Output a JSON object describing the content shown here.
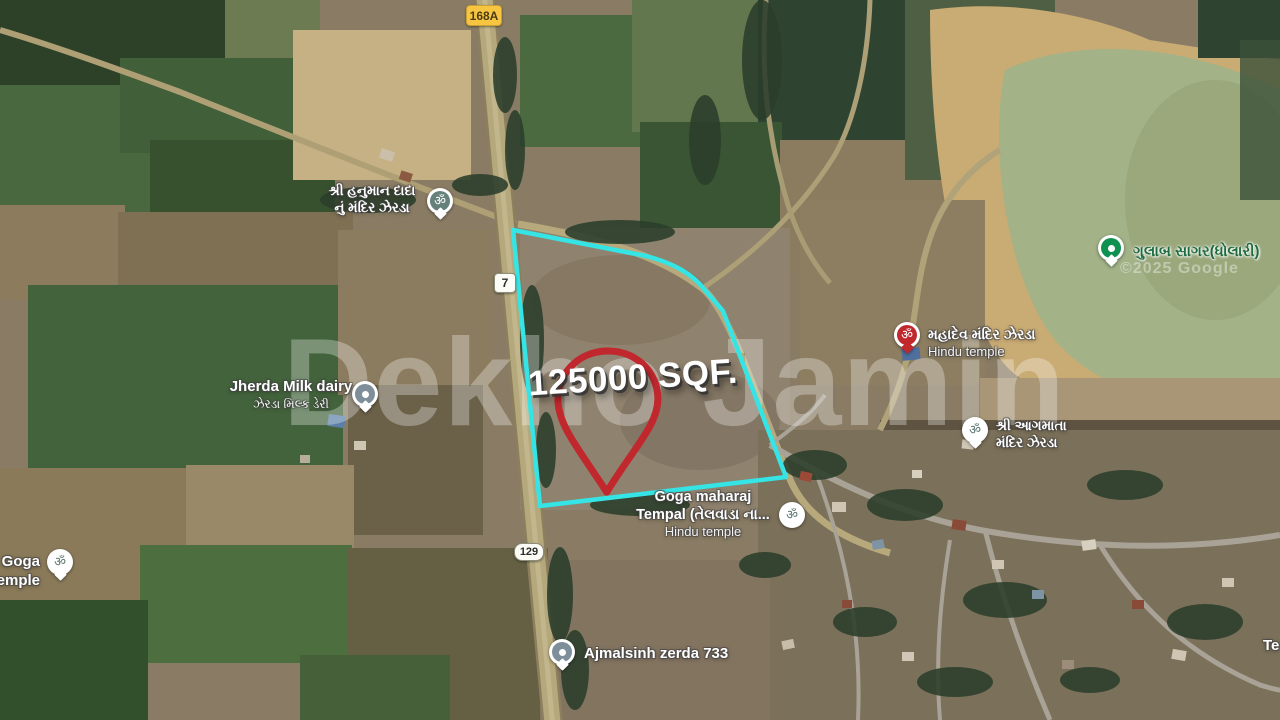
{
  "map": {
    "description": "Satellite map of land parcel for sale near Jherda (Zerda) village"
  },
  "watermark": {
    "text": "Dekho Jamin"
  },
  "credit": {
    "text": "©2025 Google"
  },
  "parcel": {
    "area_label": "125000 SQF."
  },
  "colors": {
    "accent_cyan": "#35e4e4",
    "pin_red": "#c0282e",
    "sign_yellow": "#f7c542",
    "gulab_green": "#0f9150",
    "gulab_text": "#1e6b40"
  },
  "road_signs": {
    "sign_168a": "168A",
    "sign_7": "7",
    "sign_129": "129"
  },
  "places": {
    "hanuman_temple": {
      "line1": "શ્રી હનુમાન દાદા",
      "line2": "નું મંદિર ઝેરડા"
    },
    "milk_dairy": {
      "line1": "Jherda Milk dairy",
      "line2": "ઝેરડા મિલ્ક ડેરી"
    },
    "mahadev_temple": {
      "line1": "મહાદેવ મંદિર ઝેરડા",
      "line2": "Hindu temple"
    },
    "gulab_sagar": {
      "label": "ગુલાબ સાગર(ધોલારી)"
    },
    "agmata_temple": {
      "line1": "શ્રી આગમાતા",
      "line2": "મંદિર ઝેરડા"
    },
    "goga_maharaj": {
      "line1": "Goga maharaj",
      "line2": "Tempal (તેલવાડા ના...",
      "line3": "Hindu temple"
    },
    "goga_temple_left": {
      "line1": "Goga",
      "line2": "temple"
    },
    "ajmalsinh": {
      "label": "Ajmalsinh zerda 733"
    },
    "truncated_right": {
      "label": "Te"
    }
  }
}
